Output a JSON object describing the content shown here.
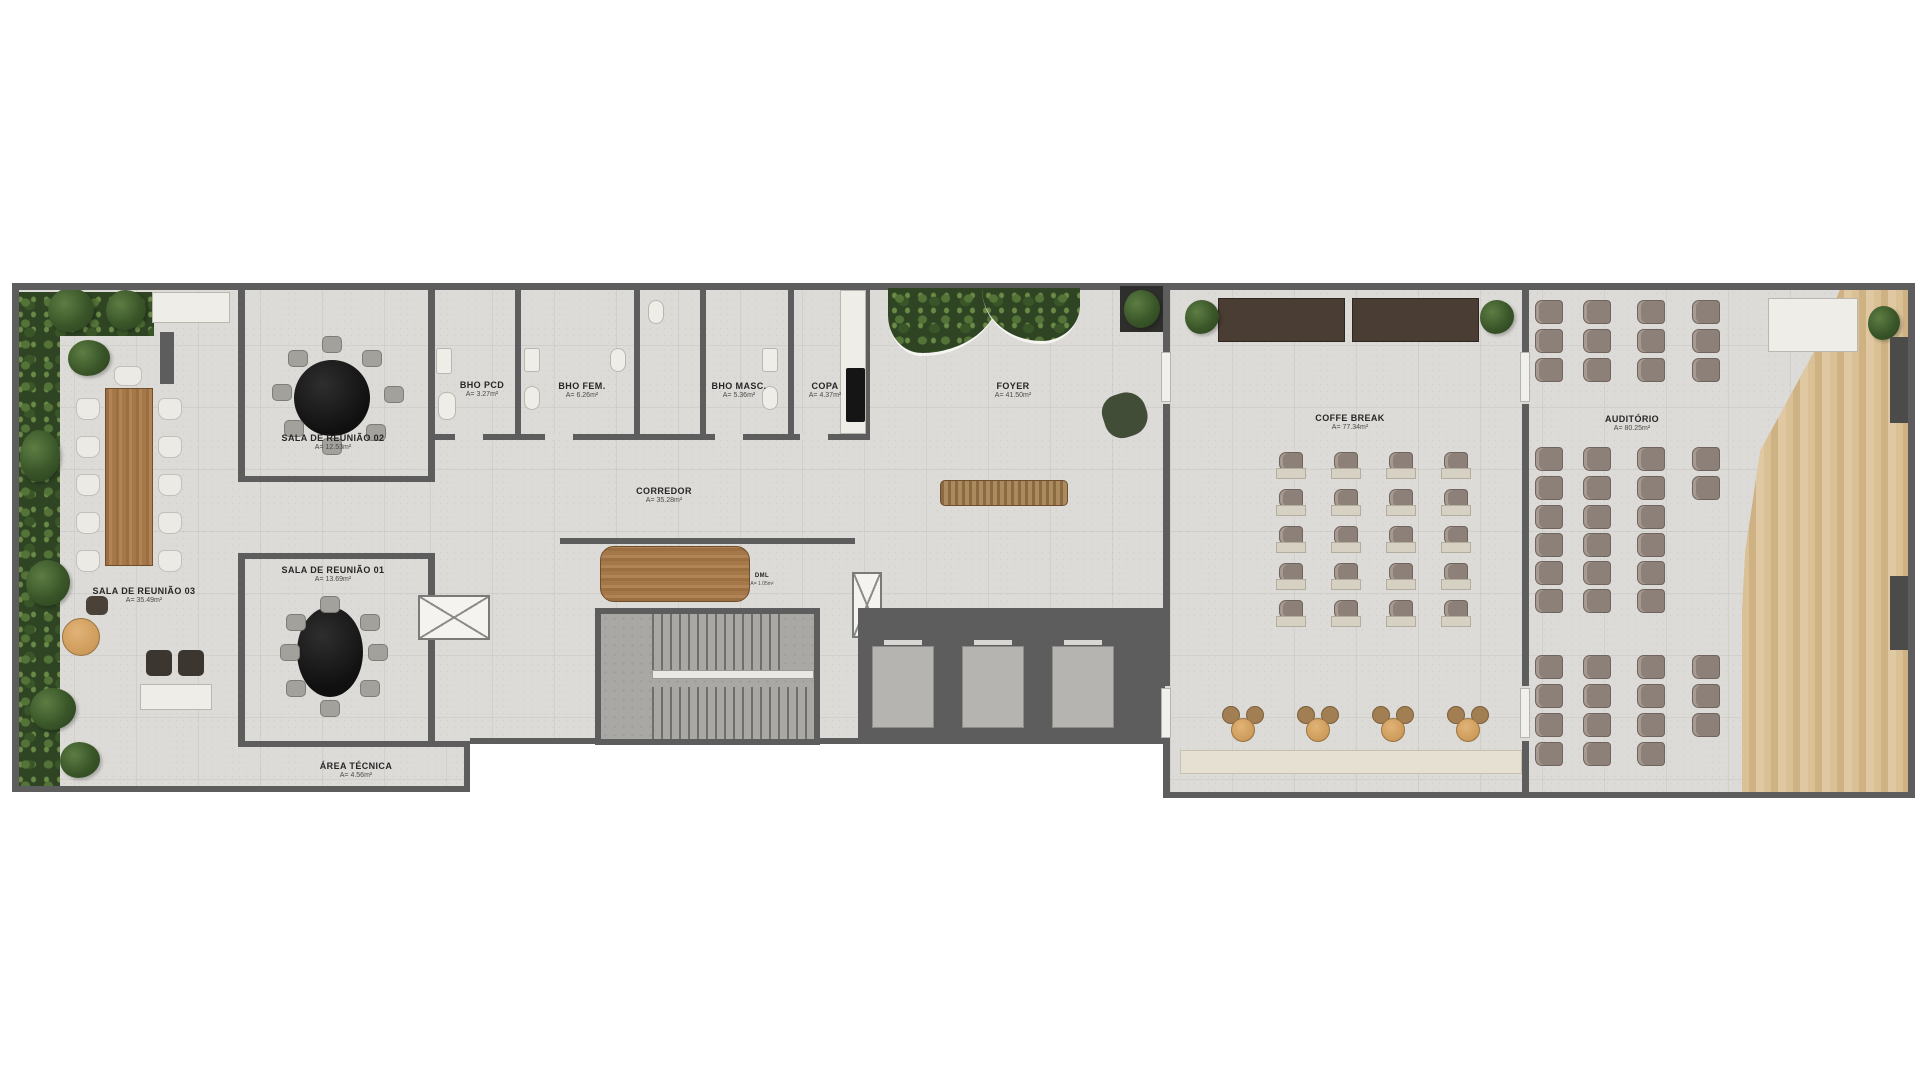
{
  "plan": {
    "title": "Floor plan — corporate event floor",
    "rooms": [
      {
        "id": "sala03",
        "name": "SALA DE REUNIÃO 03",
        "area": "A= 35.49m²"
      },
      {
        "id": "sala02",
        "name": "SALA DE REUNIÃO 02",
        "area": "A= 12.53m²"
      },
      {
        "id": "sala01",
        "name": "SALA DE REUNIÃO 01",
        "area": "A= 13.69m²"
      },
      {
        "id": "area_tecnica",
        "name": "ÁREA TÉCNICA",
        "area": "A= 4.56m²"
      },
      {
        "id": "bho_pcd",
        "name": "BHO PCD",
        "area": "A= 3.27m²"
      },
      {
        "id": "bho_fem",
        "name": "BHO FEM.",
        "area": "A= 6.26m²"
      },
      {
        "id": "bho_masc",
        "name": "BHO MASC.",
        "area": "A= 5.36m²"
      },
      {
        "id": "copa",
        "name": "COPA",
        "area": "A= 4.37m²"
      },
      {
        "id": "corredor",
        "name": "CORREDOR",
        "area": "A= 35.28m²"
      },
      {
        "id": "foyer",
        "name": "FOYER",
        "area": "A= 41.50m²"
      },
      {
        "id": "dml",
        "name": "DML",
        "area": "A= 1.05m²"
      },
      {
        "id": "coffe_break",
        "name": "COFFE BREAK",
        "area": "A= 77.34m²"
      },
      {
        "id": "auditorio",
        "name": "AUDITÓRIO",
        "area": "A= 80.25m²"
      }
    ],
    "colors": {
      "wall": "#5d5d5d",
      "floor": "#dcdbd7",
      "wood_furniture": "#b28355",
      "stage_wood": "#d9c095",
      "plant_green": "#3a5629",
      "auditorium_chair": "#8d8078",
      "black_table": "#141414"
    }
  }
}
